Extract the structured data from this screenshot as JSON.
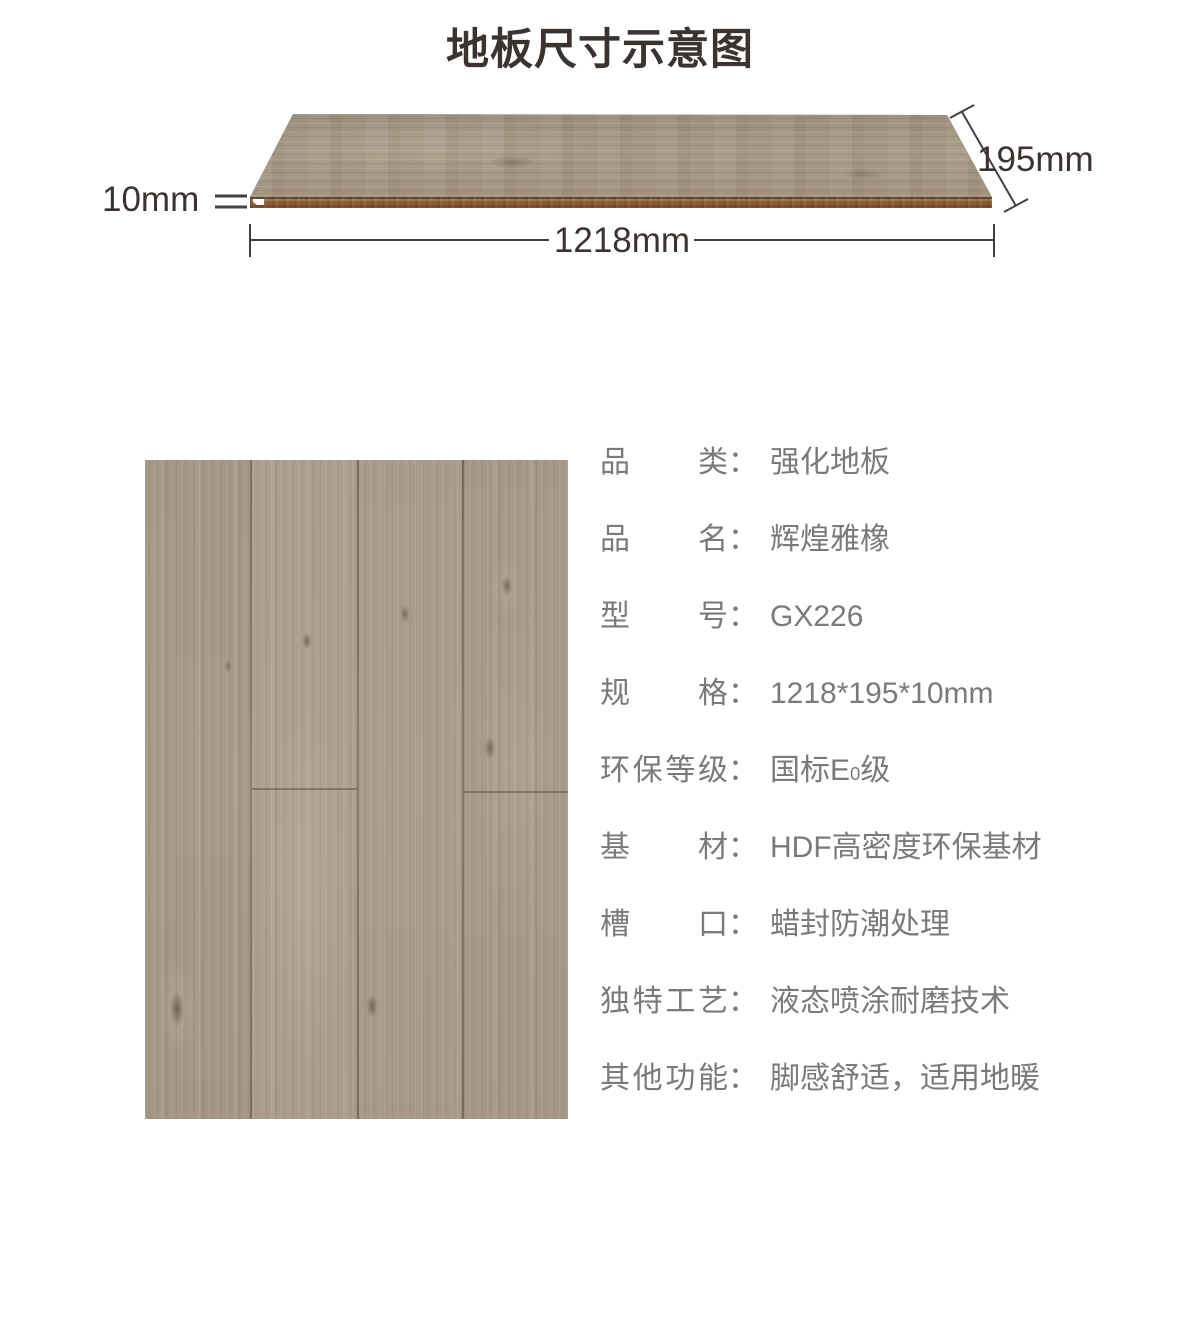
{
  "page": {
    "title": "地板尺寸示意图"
  },
  "diagram": {
    "length_label": "1218mm",
    "width_label": "195mm",
    "thickness_label": "10mm"
  },
  "specs": {
    "separator": "：",
    "rows": [
      {
        "label": "品类",
        "value": "强化地板"
      },
      {
        "label": "品名",
        "value": "辉煌雅橡"
      },
      {
        "label": "型号",
        "value": "GX226"
      },
      {
        "label": "规格",
        "value": "1218*195*10mm"
      },
      {
        "label": "环保等级",
        "value": "国标E0级",
        "value_parts": {
          "pre": "国标E",
          "sub": "0",
          "post": "级"
        }
      },
      {
        "label": "基材",
        "value": "HDF高密度环保基材"
      },
      {
        "label": "槽口",
        "value": "蜡封防潮处理"
      },
      {
        "label": "独特工艺",
        "value": "液态喷涂耐磨技术"
      },
      {
        "label": "其他功能",
        "value": "脚感舒适，适用地暖"
      }
    ]
  },
  "theme": {
    "title_color": "#3a3330",
    "dimension_text_color": "#3a3330",
    "dimension_line_color": "#45403d",
    "spec_text_color": "#7a7a7a",
    "wood_face_color": "#a2957f",
    "photo_wood_color": "#a99c8b",
    "edge_brown_color": "#96663f"
  }
}
